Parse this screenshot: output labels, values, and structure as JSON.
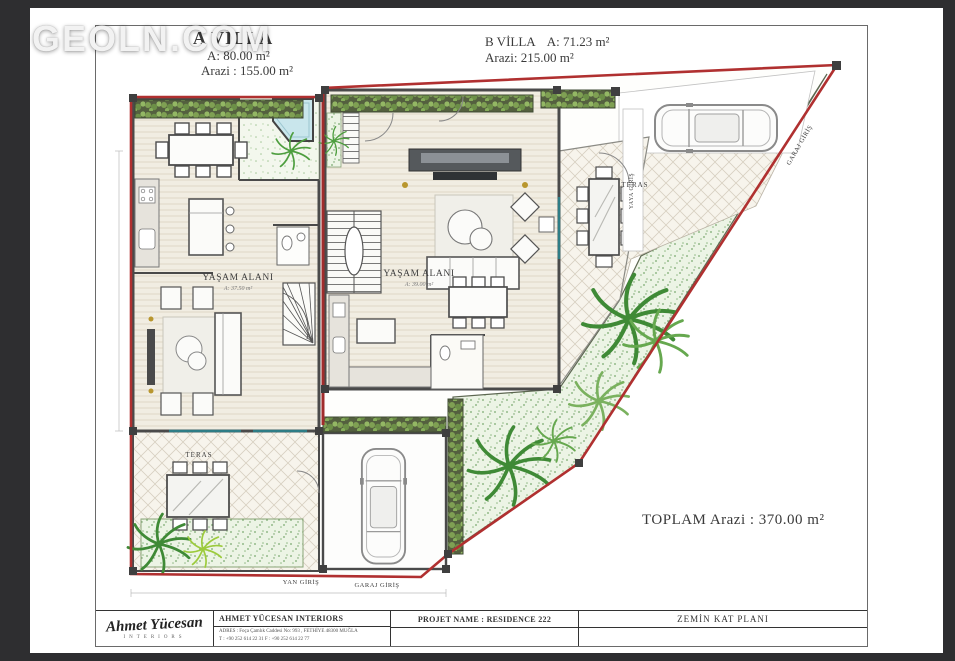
{
  "watermark": "GEOLN.COM",
  "villa_a": {
    "title": "A VİLLA",
    "area": "A: 80.00 m²",
    "land": "Arazi : 155.00 m²",
    "living_label": "YAŞAM ALANI",
    "living_area": "A: 37.50 m²"
  },
  "villa_b": {
    "title": "B VİLLA",
    "area": "A: 71.23 m²",
    "land": "Arazi: 215.00 m²",
    "living_label": "YAŞAM ALANI",
    "living_area": "A: 39.00 m²"
  },
  "site": {
    "total": "TOPLAM Arazi : 370.00 m²",
    "teras_a": "TERAS",
    "teras_b": "TERAS",
    "yan_giris": "YAN GİRİŞ",
    "garaj_giris_a": "GARAJ GİRİŞ",
    "garaj_giris_b": "GARAJ GİRİŞ",
    "yaya_giris": "YAYA GİRİŞ"
  },
  "title_block": {
    "logo_script": "Ahmet Yücesan",
    "logo_sub": "INTERIORS",
    "company": "AHMET YÜCESAN INTERIORS",
    "address1": "ADRES : Foça Çamlık Caddesi No: 993 , FETHİYE 48300 MUĞLA",
    "address2": "T : +90 252 614 22 31   F : +90 252 614 22 77",
    "project": "PROJET NAME : RESIDENCE 222",
    "sheet": "ZEMİN KAT PLANI"
  },
  "colors": {
    "boundary_red": "#b03030",
    "wall_gray": "#4a4a4a",
    "garden_green": "#79a96f",
    "hedge_green": "#54603f",
    "pool_blue": "#c9e6ec",
    "gold": "#b8962e",
    "glass_teal": "#2e7d86"
  }
}
